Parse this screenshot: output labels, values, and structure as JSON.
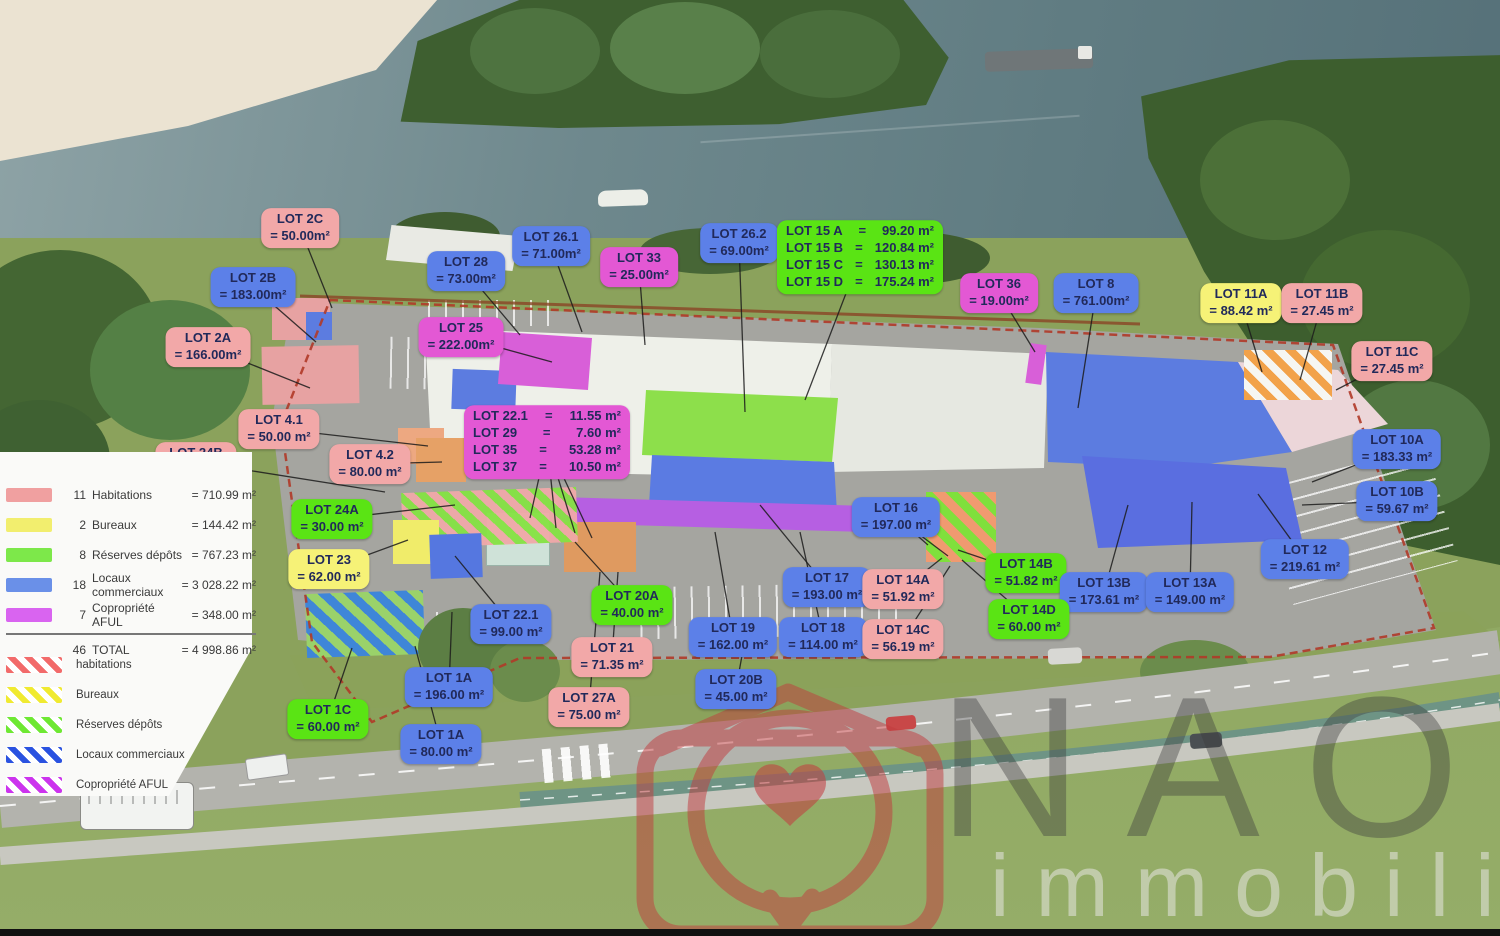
{
  "watermark": {
    "brand": "NAOS",
    "sub": "immobilier"
  },
  "colors": {
    "labels": {
      "blue": "#5c80e8",
      "pink": "#f2a8a8",
      "magenta": "#e358d4",
      "green": "#5ae414",
      "yellow": "#f6f277"
    },
    "legend": {
      "habitations": "#f0a0a0",
      "bureaux": "#f2ee6e",
      "reserves": "#7de84a",
      "locaux": "#6a90e8",
      "aful": "#d964f0"
    },
    "hatch": [
      "#f26a6a",
      "#f0ea30",
      "#6ee832",
      "#2a52e0",
      "#cc33ee"
    ]
  },
  "legend": {
    "solid": [
      {
        "count": "11",
        "label": "Habitations",
        "value": "=  710.99 m²",
        "color": "habitations"
      },
      {
        "count": "2",
        "label": "Bureaux",
        "value": "=  144.42 m²",
        "color": "bureaux"
      },
      {
        "count": "8",
        "label": "Réserves dépôts",
        "value": "=  767.23 m²",
        "color": "reserves"
      },
      {
        "count": "18",
        "label": "Locaux commerciaux",
        "value": "= 3 028.22 m²",
        "color": "locaux"
      },
      {
        "count": "7",
        "label": "Copropriété AFUL",
        "value": "=  348.00 m²",
        "color": "aful"
      },
      {
        "count": "46",
        "label": "TOTAL",
        "value": "= 4 998.86 m²",
        "color": null,
        "total": true
      }
    ],
    "hatched": [
      {
        "label": "habitations"
      },
      {
        "label": "Bureaux"
      },
      {
        "label": "Réserves dépôts"
      },
      {
        "label": "Locaux commerciaux"
      },
      {
        "label": "Copropriété AFUL"
      }
    ]
  },
  "labels": [
    {
      "id": "2C",
      "title": "LOT 2C",
      "value": "= 50.00m²",
      "color": "pink",
      "x": 300,
      "y": 228,
      "target": [
        332,
        308
      ]
    },
    {
      "id": "2B",
      "title": "LOT 2B",
      "value": "= 183.00m²",
      "color": "blue",
      "x": 253,
      "y": 287,
      "target": [
        316,
        342
      ]
    },
    {
      "id": "2A",
      "title": "LOT 2A",
      "value": "= 166.00m²",
      "color": "pink",
      "x": 208,
      "y": 347,
      "target": [
        310,
        388
      ]
    },
    {
      "id": "28",
      "title": "LOT 28",
      "value": "= 73.00m²",
      "color": "blue",
      "x": 466,
      "y": 271,
      "target": [
        520,
        335
      ]
    },
    {
      "id": "26.1",
      "title": "LOT 26.1",
      "value": "= 71.00m²",
      "color": "blue",
      "x": 551,
      "y": 246,
      "target": [
        582,
        332
      ]
    },
    {
      "id": "33",
      "title": "LOT 33",
      "value": "= 25.00m²",
      "color": "magenta",
      "x": 639,
      "y": 267,
      "target": [
        645,
        345
      ]
    },
    {
      "id": "26.2",
      "title": "LOT 26.2",
      "value": "= 69.00m²",
      "color": "blue",
      "x": 739,
      "y": 243,
      "target": [
        745,
        412
      ]
    },
    {
      "id": "15",
      "rows": [
        {
          "n": "LOT 15 A",
          "v": "99.20 m²"
        },
        {
          "n": "LOT 15 B",
          "v": "120.84 m²"
        },
        {
          "n": "LOT 15 C",
          "v": "130.13 m²"
        },
        {
          "n": "LOT 15 D",
          "v": "175.24 m²"
        }
      ],
      "color": "green",
      "x": 860,
      "y": 257,
      "target": [
        805,
        400
      ]
    },
    {
      "id": "36",
      "title": "LOT 36",
      "value": "= 19.00m²",
      "color": "magenta",
      "x": 999,
      "y": 293,
      "target": [
        1035,
        352
      ]
    },
    {
      "id": "8",
      "title": "LOT 8",
      "value": "= 761.00m²",
      "color": "blue",
      "x": 1096,
      "y": 293,
      "target": [
        1078,
        408
      ]
    },
    {
      "id": "11A",
      "title": "LOT 11A",
      "value": "= 88.42 m²",
      "color": "yellow",
      "x": 1241,
      "y": 303,
      "target": [
        1262,
        372
      ]
    },
    {
      "id": "11B",
      "title": "LOT 11B",
      "value": "= 27.45 m²",
      "color": "pink",
      "x": 1322,
      "y": 303,
      "target": [
        1300,
        380
      ]
    },
    {
      "id": "11C",
      "title": "LOT 11C",
      "value": "= 27.45 m²",
      "color": "pink",
      "x": 1392,
      "y": 361,
      "target": [
        1336,
        390
      ]
    },
    {
      "id": "25",
      "title": "LOT 25",
      "value": "= 222.00m²",
      "color": "magenta",
      "x": 461,
      "y": 337,
      "target": [
        552,
        362
      ]
    },
    {
      "id": "4.1",
      "title": "LOT 4.1",
      "value": "= 50.00 m²",
      "color": "pink",
      "x": 279,
      "y": 429,
      "target": [
        428,
        446
      ]
    },
    {
      "id": "24B",
      "title": "LOT 24B",
      "value": "= 60.00 m²",
      "color": "pink",
      "x": 196,
      "y": 462,
      "target": [
        385,
        492
      ]
    },
    {
      "id": "4.2",
      "title": "LOT 4.2",
      "value": "= 80.00 m²",
      "color": "pink",
      "x": 370,
      "y": 464,
      "target": [
        442,
        462
      ]
    },
    {
      "id": "22multi",
      "rows": [
        {
          "n": "LOT 22.1",
          "v": "11.55 m²"
        },
        {
          "n": "LOT 29",
          "v": "7.60 m²"
        },
        {
          "n": "LOT 35",
          "v": "53.28 m²"
        },
        {
          "n": "LOT 37",
          "v": "10.50 m²"
        }
      ],
      "color": "magenta",
      "x": 547,
      "y": 442,
      "targets": [
        [
          530,
          518
        ],
        [
          556,
          528
        ],
        [
          575,
          533
        ],
        [
          592,
          538
        ]
      ]
    },
    {
      "id": "10A",
      "title": "LOT 10A",
      "value": "= 183.33 m²",
      "color": "blue",
      "x": 1397,
      "y": 449,
      "target": [
        1312,
        482
      ]
    },
    {
      "id": "10B",
      "title": "LOT 10B",
      "value": "= 59.67 m²",
      "color": "blue",
      "x": 1397,
      "y": 501,
      "target": [
        1302,
        505
      ]
    },
    {
      "id": "16",
      "title": "LOT 16",
      "value": "= 197.00 m²",
      "color": "blue",
      "x": 896,
      "y": 517,
      "targets": [
        [
          928,
          545
        ],
        [
          948,
          556
        ]
      ]
    },
    {
      "id": "24A",
      "title": "LOT 24A",
      "value": "= 30.00 m²",
      "color": "green",
      "x": 332,
      "y": 519,
      "target": [
        455,
        505
      ]
    },
    {
      "id": "23",
      "title": "LOT 23",
      "value": "= 62.00 m²",
      "color": "yellow",
      "x": 329,
      "y": 569,
      "target": [
        408,
        540
      ]
    },
    {
      "id": "14B",
      "title": "LOT 14B",
      "value": "= 51.82 m²",
      "color": "green",
      "x": 1026,
      "y": 573,
      "target": [
        958,
        550
      ]
    },
    {
      "id": "13B",
      "title": "LOT 13B",
      "value": "= 173.61 m²",
      "color": "blue",
      "x": 1104,
      "y": 592,
      "target": [
        1128,
        505
      ]
    },
    {
      "id": "13A",
      "title": "LOT 13A",
      "value": "= 149.00 m²",
      "color": "blue",
      "x": 1190,
      "y": 592,
      "target": [
        1192,
        502
      ]
    },
    {
      "id": "12",
      "title": "LOT 12",
      "value": "= 219.61 m²",
      "color": "blue",
      "x": 1305,
      "y": 559,
      "target": [
        1258,
        494
      ]
    },
    {
      "id": "17",
      "title": "LOT 17",
      "value": "= 193.00 m²",
      "color": "blue",
      "x": 827,
      "y": 587,
      "target": [
        760,
        505
      ]
    },
    {
      "id": "14A",
      "title": "LOT 14A",
      "value": "= 51.92 m²",
      "color": "pink",
      "x": 903,
      "y": 589,
      "target": [
        942,
        558
      ]
    },
    {
      "id": "20A",
      "title": "LOT 20A",
      "value": "= 40.00 m²",
      "color": "green",
      "x": 632,
      "y": 605,
      "target": [
        575,
        542
      ]
    },
    {
      "id": "22.1",
      "title": "LOT 22.1",
      "value": "= 99.00 m²",
      "color": "blue",
      "x": 511,
      "y": 624,
      "target": [
        455,
        556
      ]
    },
    {
      "id": "21",
      "title": "LOT 21",
      "value": "= 71.35 m²",
      "color": "pink",
      "x": 612,
      "y": 657,
      "target": [
        618,
        572
      ]
    },
    {
      "id": "19",
      "title": "LOT 19",
      "value": "= 162.00 m²",
      "color": "blue",
      "x": 733,
      "y": 637,
      "target": [
        715,
        532
      ]
    },
    {
      "id": "18",
      "title": "LOT 18",
      "value": "= 114.00 m²",
      "color": "blue",
      "x": 823,
      "y": 637,
      "target": [
        800,
        532
      ]
    },
    {
      "id": "14C",
      "title": "LOT 14C",
      "value": "= 56.19 m²",
      "color": "pink",
      "x": 903,
      "y": 639,
      "target": [
        950,
        566
      ]
    },
    {
      "id": "14D",
      "title": "LOT 14D",
      "value": "= 60.00 m²",
      "color": "green",
      "x": 1029,
      "y": 619,
      "target": [
        962,
        560
      ]
    },
    {
      "id": "20B",
      "title": "LOT 20B",
      "value": "= 45.00 m²",
      "color": "blue",
      "x": 736,
      "y": 689,
      "target": [
        748,
        622
      ]
    },
    {
      "id": "27A",
      "title": "LOT 27A",
      "value": "= 75.00 m²",
      "color": "pink",
      "x": 589,
      "y": 707,
      "target": [
        600,
        572
      ]
    },
    {
      "id": "1A-1",
      "title": "LOT 1A",
      "value": "= 196.00 m²",
      "color": "blue",
      "x": 449,
      "y": 687,
      "target": [
        452,
        612
      ]
    },
    {
      "id": "1C",
      "title": "LOT 1C",
      "value": "= 60.00 m²",
      "color": "green",
      "x": 328,
      "y": 719,
      "target": [
        352,
        648
      ]
    },
    {
      "id": "1A-2",
      "title": "LOT 1A",
      "value": "= 80.00 m²",
      "color": "blue",
      "x": 441,
      "y": 744,
      "target": [
        415,
        646
      ]
    }
  ]
}
